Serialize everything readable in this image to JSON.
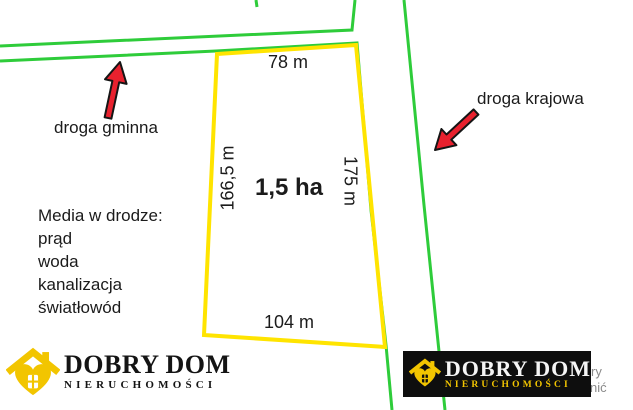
{
  "colors": {
    "road_green": "#2ecc3a",
    "plot_yellow": "#ffe400",
    "arrow_red": "#e8212e",
    "logo_gold": "#f2c500",
    "logo_box_bg": "#0e0e0e",
    "ink": "#1b1b1b",
    "fragment_gray": "#8a8a8a"
  },
  "diagram": {
    "plot": {
      "area_label": "1,5 ha",
      "top_side": "78 m",
      "left_side": "166,5 m",
      "right_side": "175 m",
      "bottom_side": "104 m"
    },
    "roads": {
      "top_road_label": "droga gminna",
      "right_road_label": "droga krajowa"
    },
    "media": {
      "title": "Media w drodze:",
      "items": [
        "prąd",
        "woda",
        "kanalizacja",
        "światłowód"
      ]
    }
  },
  "branding": {
    "logo_light": {
      "title": "DOBRY DOM",
      "subtitle": "NIERUCHOMOŚCI"
    },
    "logo_dark": {
      "title": "DOBRY DOM",
      "subtitle": "NIERUCHOMOŚCI"
    },
    "edge_fragments": {
      "line1": "ry",
      "line2": "nić"
    }
  }
}
